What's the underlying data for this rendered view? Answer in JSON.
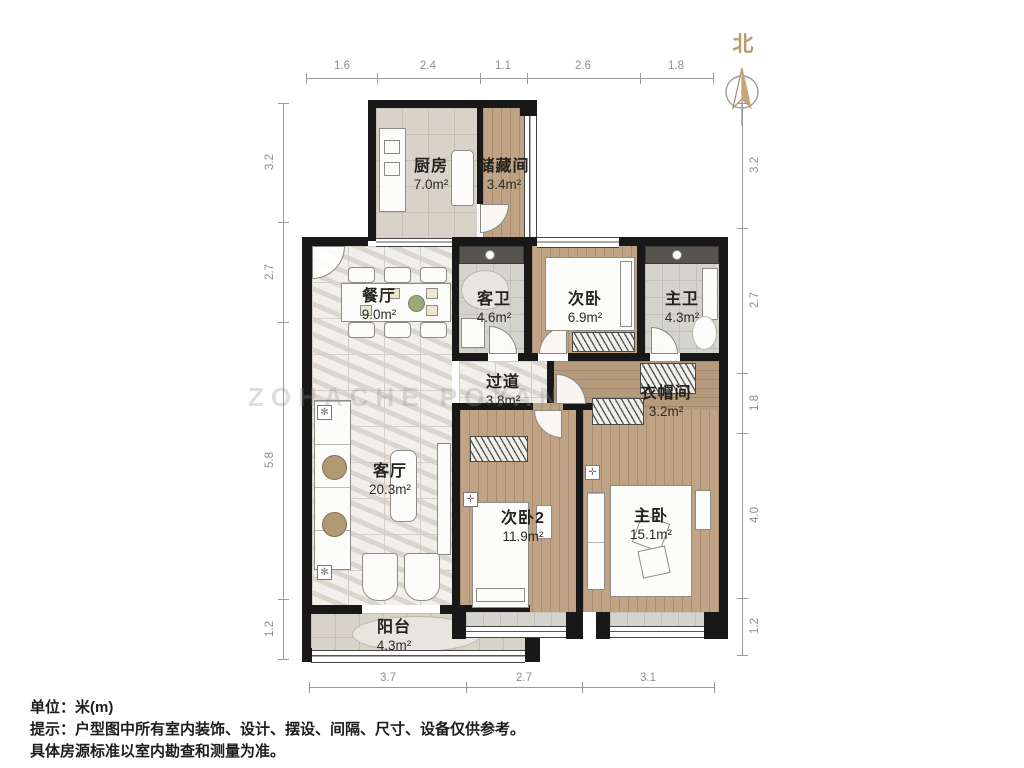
{
  "north_label": "北",
  "watermark": "ZOHACHE POYAN",
  "rooms": {
    "kitchen": {
      "name": "厨房",
      "area": "7.0m²"
    },
    "storage": {
      "name": "储藏间",
      "area": "3.4m²"
    },
    "dining": {
      "name": "餐厅",
      "area": "9.0m²"
    },
    "guest_bath": {
      "name": "客卫",
      "area": "4.6m²"
    },
    "bedroom_c": {
      "name": "次卧",
      "area": "6.9m²"
    },
    "master_bath": {
      "name": "主卫",
      "area": "4.3m²"
    },
    "hallway": {
      "name": "过道",
      "area": "3.8m²"
    },
    "cloakroom": {
      "name": "衣帽间",
      "area": "3.2m²"
    },
    "living": {
      "name": "客厅",
      "area": "20.3m²"
    },
    "bedroom2": {
      "name": "次卧2",
      "area": "11.9m²"
    },
    "master_bedroom": {
      "name": "主卧",
      "area": "15.1m²"
    },
    "balcony": {
      "name": "阳台",
      "area": "4.3m²"
    }
  },
  "dimensions": {
    "top": [
      "1.6",
      "2.4",
      "1.1",
      "2.6",
      "1.8"
    ],
    "bottom": [
      "3.7",
      "2.7",
      "3.1"
    ],
    "left": [
      "3.2",
      "2.7",
      "5.8",
      "1.2"
    ],
    "right": [
      "3.2",
      "2.7",
      "1.8",
      "4.0",
      "1.2"
    ]
  },
  "notes": {
    "unit": "单位：米(m)",
    "tip1": "提示：户型图中所有室内装饰、设计、摆设、间隔、尺寸、设备仅供参考。",
    "tip2": "具体房源标准以室内勘查和测量为准。"
  },
  "colors": {
    "wall": "#181818",
    "wood_floor": "#c0a385",
    "north_accent": "#c8a279"
  }
}
